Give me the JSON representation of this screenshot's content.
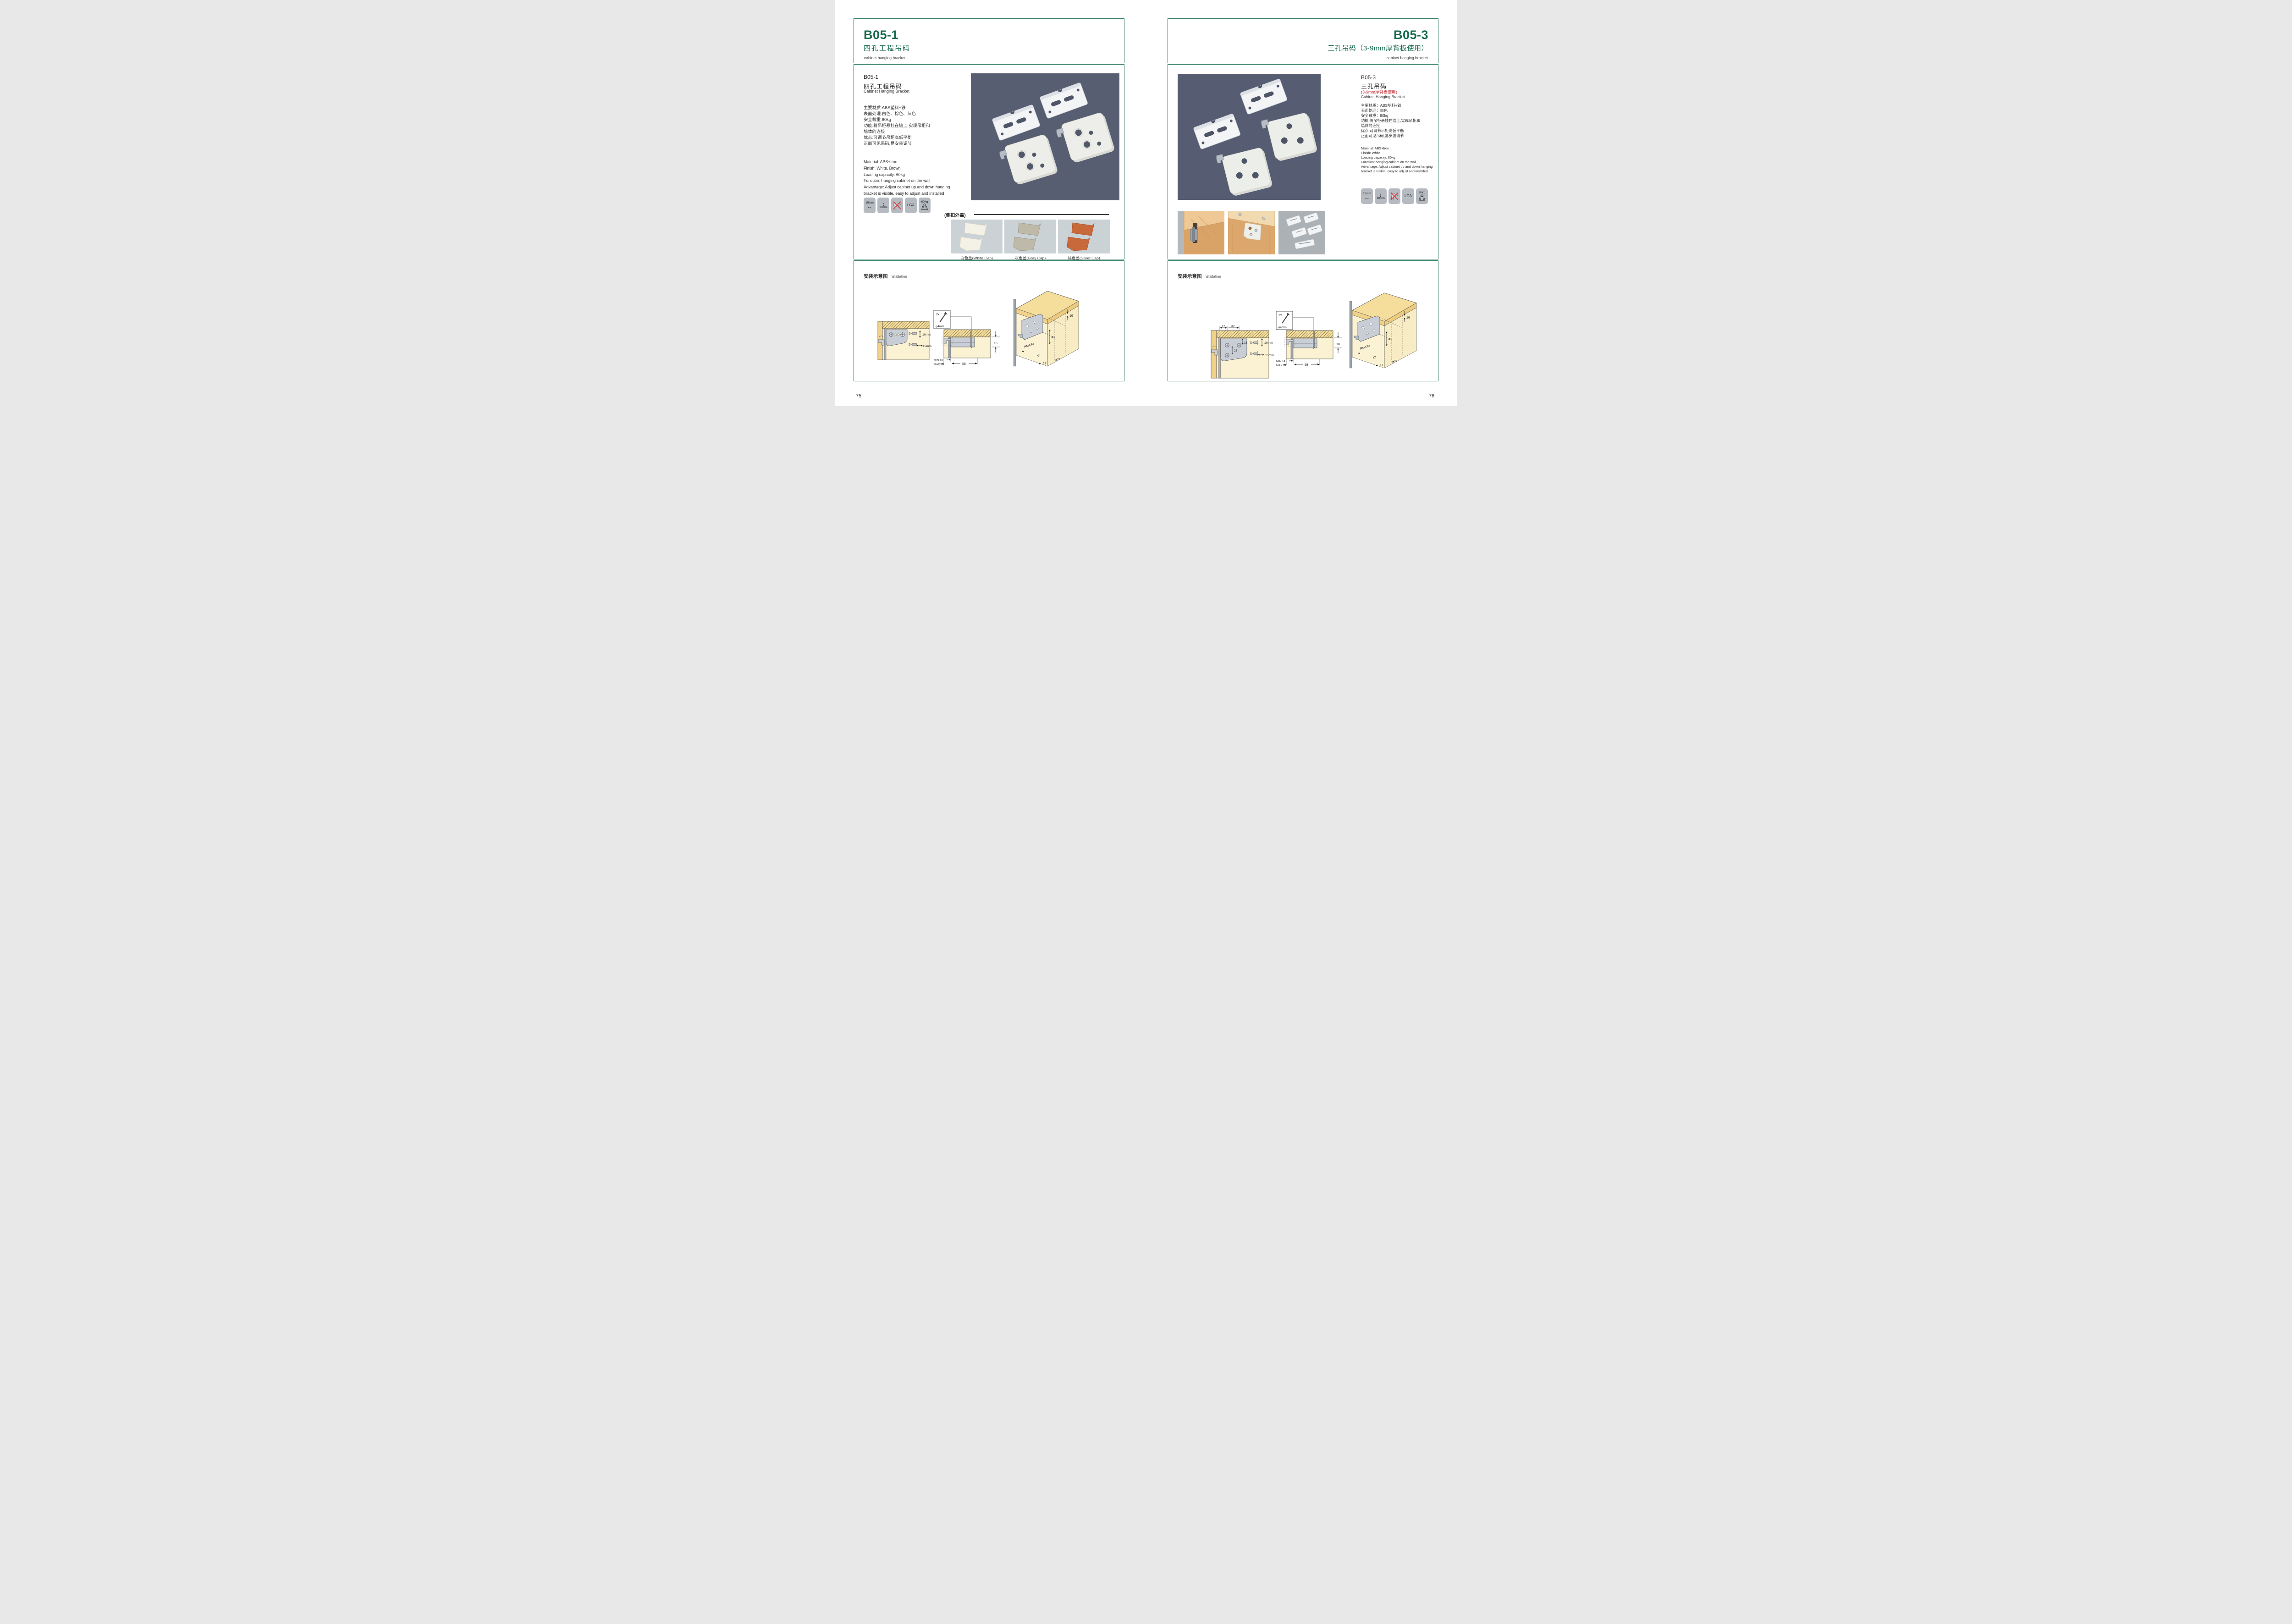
{
  "colors": {
    "green": "#15694B",
    "red": "#C1272D",
    "frame": "#2E7C5E",
    "photo_bg": "#575E71",
    "caps_bg": "#CBD2D6"
  },
  "left": {
    "header": {
      "code": "B05-1",
      "title": "四孔工程吊码",
      "subtitle": "cabinet hanging bracket"
    },
    "product": {
      "code": "B05-1",
      "name_cn": "四孔工程吊码",
      "name_en": "Cabinet Hanging Bracket",
      "specs_cn": [
        "主要材质:ABS塑料+铁",
        "表面处理:白色、棕色、灰色",
        "安全载重:60kg",
        "功能:将吊柜悬挂在墙上,实现吊柜和",
        "墙体的连接",
        "优点:可调节吊柜高低平衡",
        "正面可见吊码,易安装调节"
      ],
      "specs_en": [
        "Material: ABS+Iron",
        "Finish: White, Brown",
        "Loading capacity: 60kg",
        "Function: hanging cabinet on the wall",
        "Advantage: Adjust cabinet up and down hanging",
        "bracket is visible, easy to adjust and installed"
      ],
      "icons": {
        "width": "15mm",
        "height": "10mm",
        "lga": "LGA",
        "load": "60Kg"
      },
      "caps_title": "(侧扣外盖)",
      "caps": [
        "白色盖(White Cap)",
        "灰色盖(Gray Cap)",
        "棕色盖(Silver Cap)"
      ]
    },
    "install": {
      "title": "安装示意图",
      "subtitle": "Installation",
      "d1": {
        "drill_v": "10mm",
        "drill_h": "15mm"
      },
      "d2": {
        "qty": "2x",
        "dia": "φ4mm",
        "board": "18",
        "min": "MIN.10",
        "max": "MAX.23",
        "depth": "58"
      },
      "d3": {
        "edge": "16",
        "height": "42",
        "radius": "RMAX4",
        "side": "16",
        "off1": "17",
        "off2": "32"
      }
    },
    "page_number": "75"
  },
  "right": {
    "header": {
      "code": "B05-3",
      "title": "三孔吊码（3-9mm厚背板使用）",
      "subtitle": "cabinet hanging bracket"
    },
    "product": {
      "code": "B05-3",
      "name_cn": "三孔吊码",
      "name_note": "(3-9mm厚背板使用)",
      "name_en": "Cabinet Hanging Bracket",
      "specs_cn": [
        "主要材质：ABS塑料+铁",
        "表面处理：白色",
        "安全载重：80kg",
        "功能:将吊柜悬挂在墙上,实现吊柜和",
        "墙体的连接",
        "优点:可调节吊柜高低平衡",
        "正面可见吊码,易安装调节"
      ],
      "specs_en": [
        "Material: ABS+Iron",
        "Finish: White",
        "Loading capacity: 80kg",
        "Function: hanging cabinet on the wall",
        "Advantage: Adjust cabinet up and down hanging",
        "bracket is visible, easy to adjust and installed"
      ],
      "icons": {
        "width": "15mm",
        "height": "10mm",
        "lga": "LGA",
        "load": "80Kg"
      }
    },
    "install": {
      "title": "安装示意图",
      "subtitle": "Installation",
      "d1": {
        "top1": "17",
        "top2": "32",
        "in1": "16",
        "in2": "25",
        "drill_v": "10mm",
        "drill_h": "15mm"
      },
      "d2": {
        "qty": "2x",
        "dia": "φ4mm",
        "board": "18",
        "min": "MIN.14",
        "max": "MAX.24",
        "depth": "58"
      },
      "d3": {
        "edge": "16",
        "height": "42",
        "radius": "RMAX4",
        "side": "18",
        "off1": "17",
        "off2": "32"
      }
    },
    "page_number": "76"
  }
}
